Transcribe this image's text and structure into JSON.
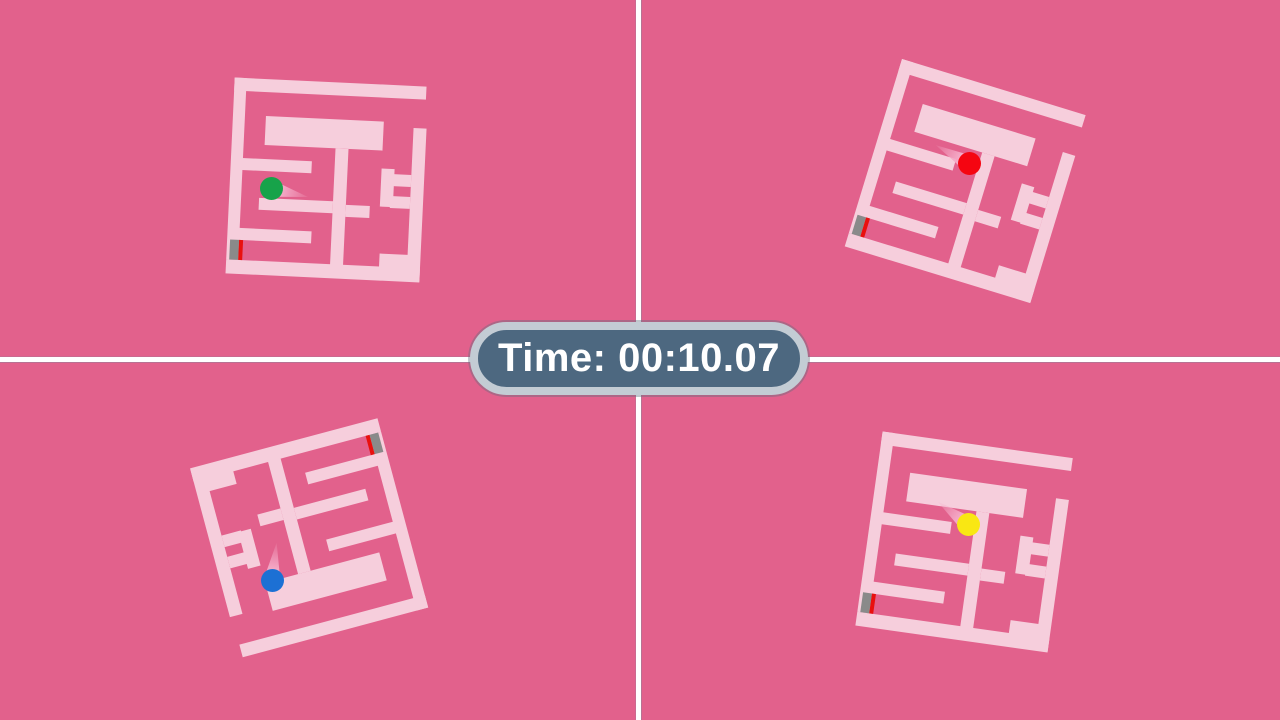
{
  "hud": {
    "timer_label": "Time: 00:10.07",
    "pill_bg": "#4d6880",
    "pill_border": "#c3ccd4",
    "pill_text_color": "#ffffff"
  },
  "scene": {
    "background": "#e2618c",
    "divider_color": "#ffffff",
    "wall_color": "#f6cedc",
    "trail_color": "#f4a9c6",
    "goal_gray": "#8a8a8a",
    "goal_red": "#e9100e"
  },
  "maze_template": {
    "width": 194,
    "height": 197,
    "walls": [
      [
        0,
        0,
        192,
        13
      ],
      [
        0,
        0,
        12,
        182
      ],
      [
        33,
        37,
        118,
        29
      ],
      [
        104,
        66,
        13,
        120
      ],
      [
        30,
        119,
        74,
        12
      ],
      [
        9,
        80,
        72,
        12
      ],
      [
        181,
        42,
        13,
        153
      ],
      [
        151,
        84,
        13,
        38
      ],
      [
        163,
        89,
        18,
        12
      ],
      [
        161,
        111,
        20,
        12
      ],
      [
        117,
        122,
        24,
        12
      ],
      [
        9,
        150,
        75,
        12
      ],
      [
        0,
        182,
        194,
        14
      ],
      [
        153,
        169,
        31,
        26
      ]
    ],
    "goal": {
      "gray": [
        3,
        162,
        9,
        20
      ],
      "red": [
        12,
        162,
        4,
        20
      ]
    }
  },
  "quadrants": [
    {
      "name": "top-left",
      "player": "green",
      "ball_color": "#17a34a",
      "center_x": 327,
      "center_y": 180,
      "rotation_deg": 2.7,
      "ball_x": 271,
      "ball_y": 188,
      "trail_angle_deg": 13
    },
    {
      "name": "top-right",
      "player": "red",
      "ball_color": "#f50511",
      "center_x": 966,
      "center_y": 181,
      "rotation_deg": 17,
      "ball_x": 969,
      "ball_y": 163,
      "trail_angle_deg": 209
    },
    {
      "name": "bottom-left",
      "player": "blue",
      "ball_color": "#1c70d4",
      "center_x": 309,
      "center_y": 537,
      "rotation_deg": 165,
      "ball_x": 272,
      "ball_y": 580,
      "trail_angle_deg": 277
    },
    {
      "name": "bottom-right",
      "player": "yellow",
      "ball_color": "#f9e713",
      "center_x": 965,
      "center_y": 542,
      "rotation_deg": 8,
      "ball_x": 968,
      "ball_y": 524,
      "trail_angle_deg": 217
    }
  ]
}
